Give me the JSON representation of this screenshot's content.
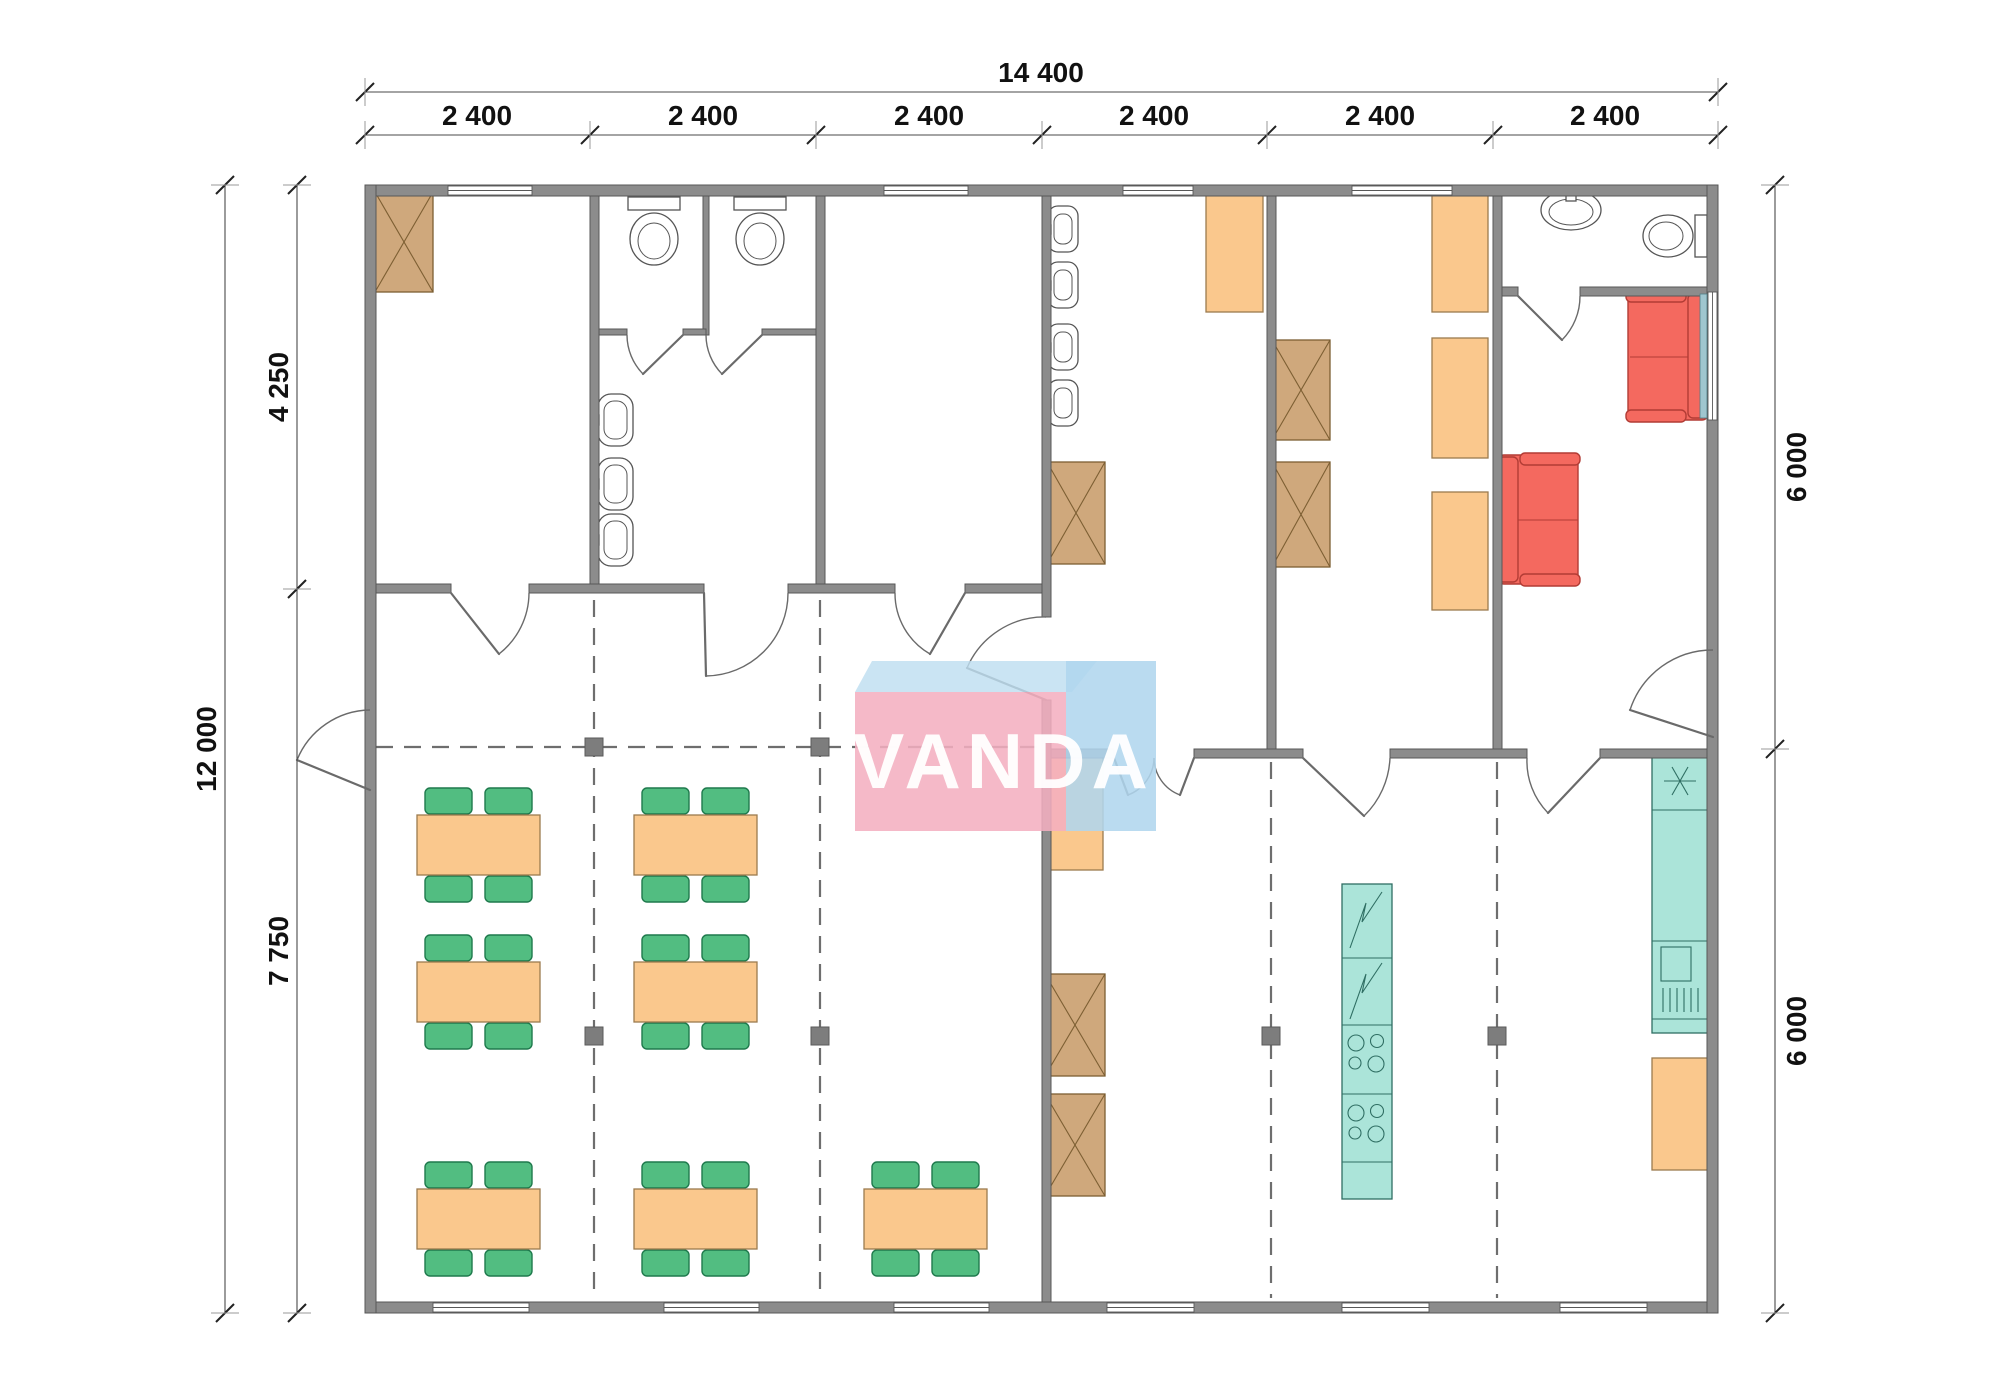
{
  "page": {
    "type": "architectural-floor-plan",
    "background": "#ffffff"
  },
  "watermark": {
    "text": "VANDA",
    "pink": "#f3afc0",
    "blue": "#b0d6ee",
    "lid": "#bedef0",
    "text_color": "#ffffff"
  },
  "dimensions": {
    "top_total": "14 400",
    "top_segments": [
      "2 400",
      "2 400",
      "2 400",
      "2 400",
      "2 400",
      "2 400"
    ],
    "left_total": "12 000",
    "left_splits": [
      "4 250",
      "7 750"
    ],
    "right_splits": [
      "6 000",
      "6 000"
    ]
  },
  "colors": {
    "wall": "#8c8c8c",
    "wardrobe_tan": "#cfa87c",
    "furniture_orange": "#fac88d",
    "chair_green": "#52bd81",
    "sofa_red": "#f4695f",
    "kitchen_teal": "#abe4d9",
    "module_dash": "#6e6e6e"
  },
  "icons": {
    "wardrobe": "x-crossed-box-icon",
    "fridge": "snowflake-icon",
    "appliance": "zigzag-icon",
    "hob": "four-burner-icon",
    "door": "quarter-arc-icon",
    "window": "double-line-icon"
  },
  "rooms": [
    {
      "name": "storage-room",
      "furniture": [
        "wardrobe"
      ],
      "openings": [
        "window",
        "door-to-hall"
      ]
    },
    {
      "name": "wc-stalls-washroom",
      "furniture": [
        "toilet",
        "toilet",
        "sink",
        "sink",
        "sink"
      ],
      "openings": [
        "door-to-hall",
        "2 stall doors"
      ]
    },
    {
      "name": "empty-room",
      "furniture": [],
      "openings": [
        "window",
        "door-to-hall"
      ]
    },
    {
      "name": "urinal-room",
      "furniture": [
        "urinal",
        "urinal",
        "urinal",
        "urinal",
        "wardrobe",
        "locker"
      ],
      "openings": [
        "window",
        "door-to-hall",
        "double-door-to-canteen"
      ]
    },
    {
      "name": "locker-room",
      "furniture": [
        "wardrobe",
        "wardrobe",
        "locker",
        "locker",
        "locker"
      ],
      "openings": [
        "window",
        "door-to-canteen"
      ]
    },
    {
      "name": "wc-small",
      "furniture": [
        "sink",
        "toilet"
      ],
      "openings": [
        "door-to-lounge"
      ]
    },
    {
      "name": "lounge",
      "furniture": [
        "sofa",
        "sofa"
      ],
      "openings": [
        "window",
        "exterior-door",
        "door-to-canteen"
      ]
    },
    {
      "name": "dining-hall",
      "furniture": [
        "7 tables",
        "28 chairs"
      ],
      "openings": [
        "exterior-door",
        "3 windows"
      ]
    },
    {
      "name": "kitchen-canteen",
      "furniture": [
        "locker",
        "wardrobe",
        "wardrobe",
        "kitchen-island",
        "fridge-counter-sink",
        "locker"
      ],
      "openings": [
        "3 windows"
      ]
    }
  ]
}
